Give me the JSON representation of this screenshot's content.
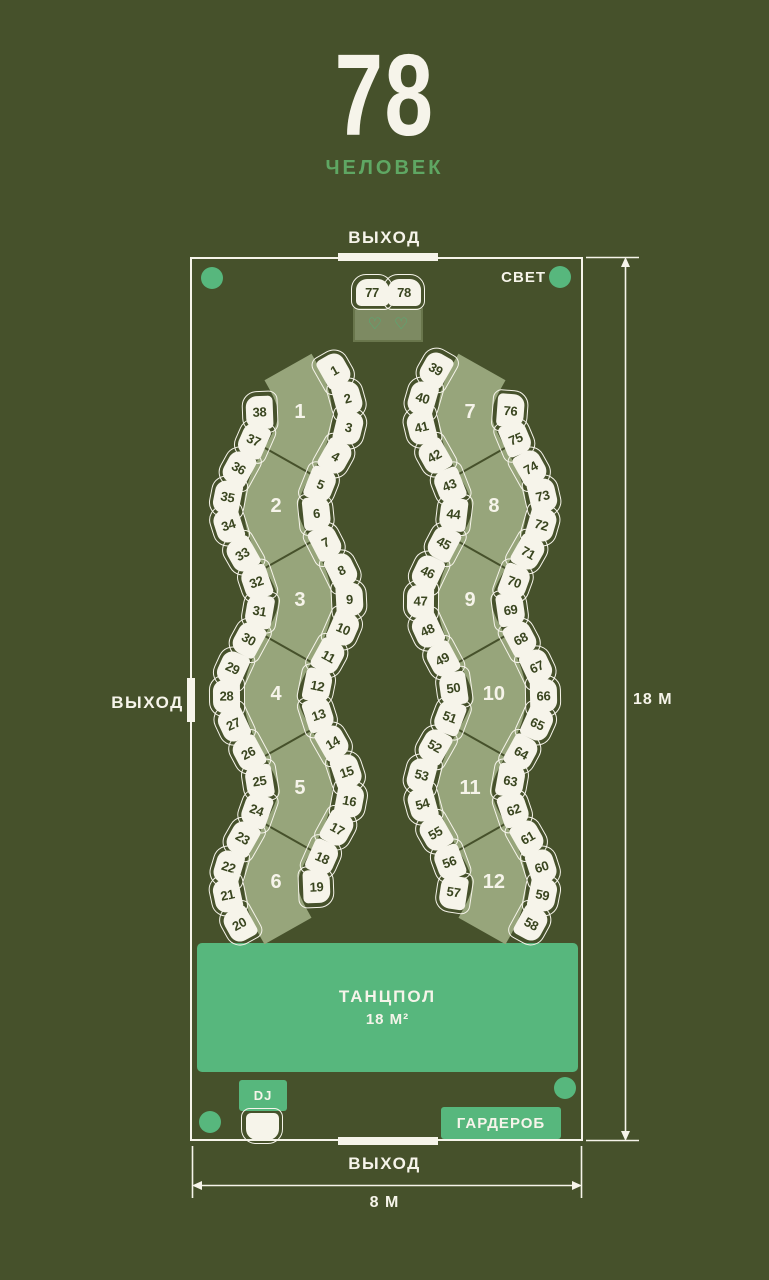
{
  "header": {
    "count": "78",
    "label": "ЧЕЛОВЕК"
  },
  "exits": {
    "top": "ВЫХОД",
    "left": "ВЫХОД",
    "bottom": "ВЫХОД"
  },
  "light_label": "СВЕТ",
  "dance_floor": {
    "line1": "ТАНЦПОЛ",
    "line2": "18 М²"
  },
  "dj_label": "DJ",
  "wardrobe_label": "ГАРДЕРОБ",
  "dimensions": {
    "height": "18 М",
    "width": "8 М"
  },
  "tables": {
    "left_segments": [
      "1",
      "2",
      "3",
      "4",
      "5",
      "6"
    ],
    "right_segments": [
      "7",
      "8",
      "9",
      "10",
      "11",
      "12"
    ]
  },
  "seats": {
    "left_inner": [
      "1",
      "2",
      "3",
      "4",
      "5",
      "6",
      "7",
      "8",
      "9",
      "10",
      "11",
      "12",
      "13",
      "14",
      "15",
      "16",
      "17",
      "18",
      "19"
    ],
    "left_outer": [
      "38",
      "37",
      "36",
      "35",
      "34",
      "33",
      "32",
      "31",
      "30",
      "29",
      "28",
      "27",
      "26",
      "25",
      "24",
      "23",
      "22",
      "21",
      "20"
    ],
    "right_inner": [
      "39",
      "40",
      "41",
      "42",
      "43",
      "44",
      "45",
      "46",
      "47",
      "48",
      "49",
      "50",
      "51",
      "52",
      "53",
      "54",
      "55",
      "56",
      "57"
    ],
    "right_outer": [
      "76",
      "75",
      "74",
      "73",
      "72",
      "71",
      "70",
      "69",
      "68",
      "67",
      "66",
      "65",
      "64",
      "63",
      "62",
      "61",
      "60",
      "59",
      "58"
    ]
  },
  "sweetheart": {
    "seats": [
      "77",
      "78"
    ],
    "hearts": [
      "♡",
      "♡"
    ]
  },
  "colors": {
    "bg": "#46512b",
    "cream": "#f6f4ea",
    "band": "#97a57b",
    "accent": "#57b77d",
    "subtitle": "#5fa763",
    "heart": "#4db378",
    "chairText": "#39451f",
    "sweetheartFill": "#7d8a62",
    "sweetheartBorder": "#69764c"
  }
}
